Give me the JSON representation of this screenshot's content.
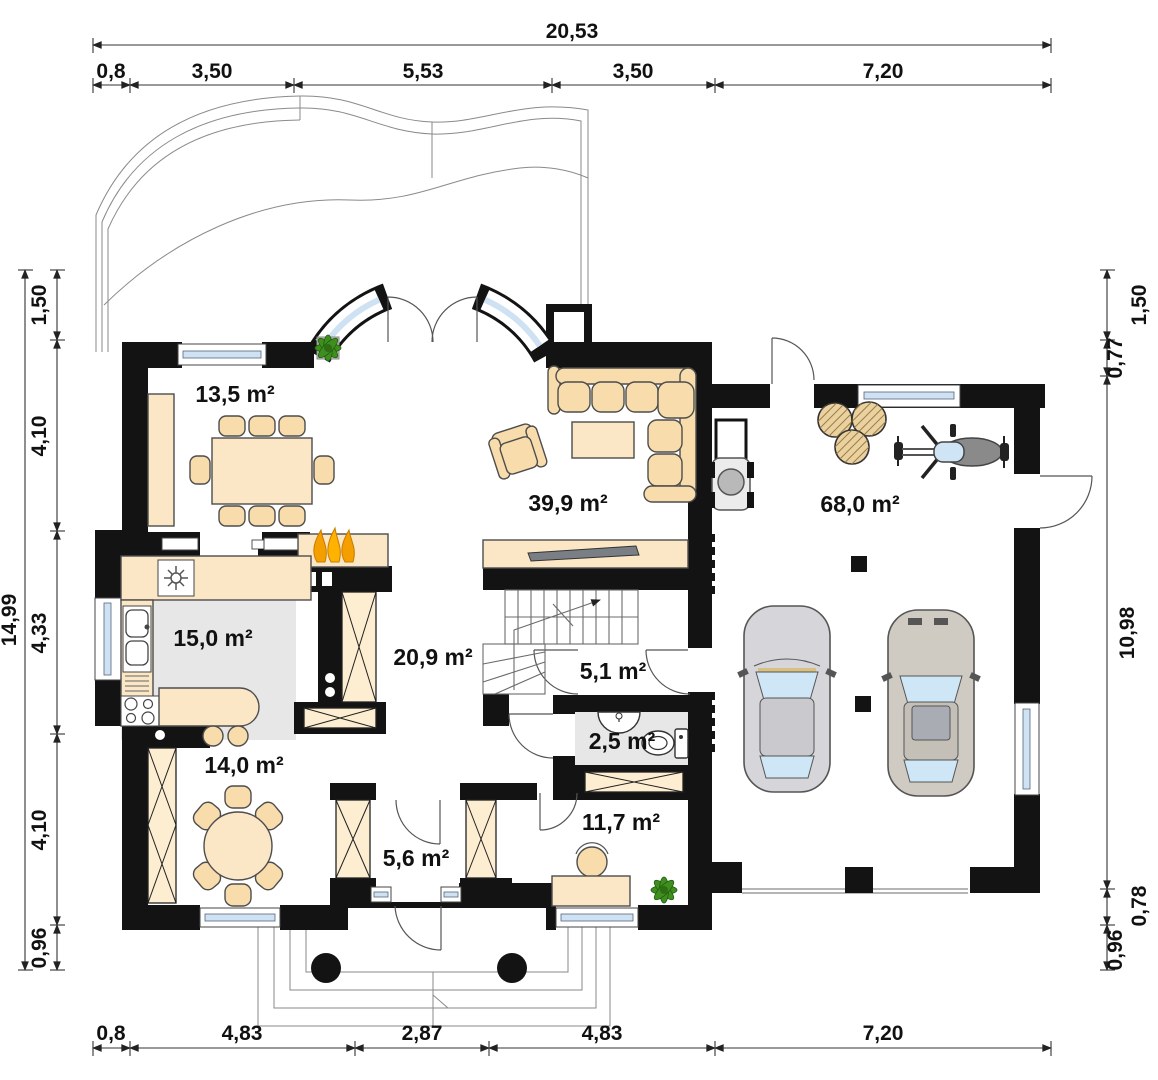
{
  "rooms": {
    "dining": "13,5 m²",
    "living": "39,9 m²",
    "garage": "68,0 m²",
    "kitchen": "15,0 m²",
    "hall": "20,9 m²",
    "corridor": "5,1 m²",
    "wc": "2,5 m²",
    "room": "14,0 m²",
    "vestibule": "5,6 m²",
    "office": "11,7 m²"
  },
  "dims": {
    "top_total": "20,53",
    "top": [
      "0,8",
      "3,50",
      "5,53",
      "3,50",
      "7,20"
    ],
    "bottom": [
      "0,8",
      "4,83",
      "2,87",
      "4,83",
      "7,20"
    ],
    "left_total": "14,99",
    "left": [
      "1,50",
      "4,10",
      "4,33",
      "4,10",
      "0,96"
    ],
    "right": [
      "1,50",
      "0,77",
      "10,98",
      "0,78",
      "0,96"
    ]
  },
  "colors": {
    "wall": "#131313",
    "furniture_cream": "#fbe7c6",
    "glass_blue": "#cfe2f3",
    "floor_gray": "#e7e7e7",
    "flame_orange": "#f59e00",
    "flame_yellow": "#ffd34d",
    "plant_green": "#3f8f1f",
    "car_left_body": "#d6d6da",
    "car_right_body": "#cfcbc3"
  }
}
